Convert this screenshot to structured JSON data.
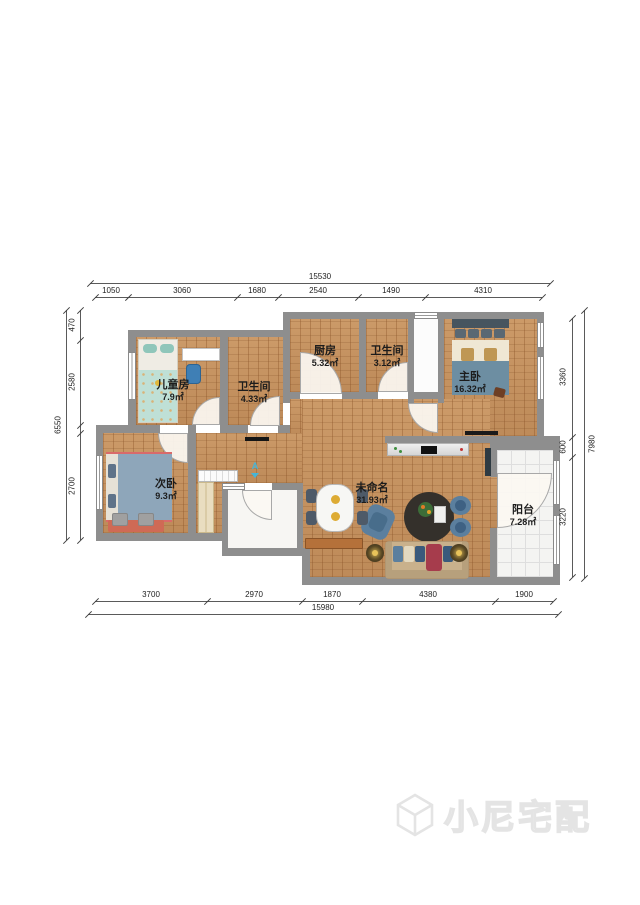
{
  "rooms": {
    "children": {
      "name": "儿童房",
      "area": "7.9㎡"
    },
    "bath1": {
      "name": "卫生间",
      "area": "4.33㎡"
    },
    "kitchen": {
      "name": "厨房",
      "area": "5.32㎡"
    },
    "bath2": {
      "name": "卫生间",
      "area": "3.12㎡"
    },
    "master": {
      "name": "主卧",
      "area": "16.32㎡"
    },
    "second": {
      "name": "次卧",
      "area": "9.3㎡"
    },
    "living": {
      "name": "未命名",
      "area": "31.93㎡"
    },
    "balcony": {
      "name": "阳台",
      "area": "7.28㎡"
    }
  },
  "dims": {
    "top_total": "15530",
    "top": [
      "1050",
      "3060",
      "1680",
      "2540",
      "1490",
      "4310"
    ],
    "bottom": [
      "3700",
      "2970",
      "1870",
      "4380",
      "1900"
    ],
    "bottom_total": "15980",
    "left_total": "6550",
    "left": [
      "470",
      "2580",
      "2700"
    ],
    "right_total": "7980",
    "right": [
      "3360",
      "600",
      "3220"
    ]
  },
  "marker": {
    "label": "A"
  },
  "watermark": {
    "brand": "小尼宅配",
    "logo": "cube-outline-logo"
  },
  "colors": {
    "wall": "#8e8e8e",
    "wood_floor": "#c6925f",
    "balcony_tile": "#f4f4f2",
    "accent_blue": "#5b7f9e",
    "bed_teal": "#bfe0d6",
    "sofa_tan": "#c9b18c",
    "watermark_gray": "#e4e4e4"
  }
}
